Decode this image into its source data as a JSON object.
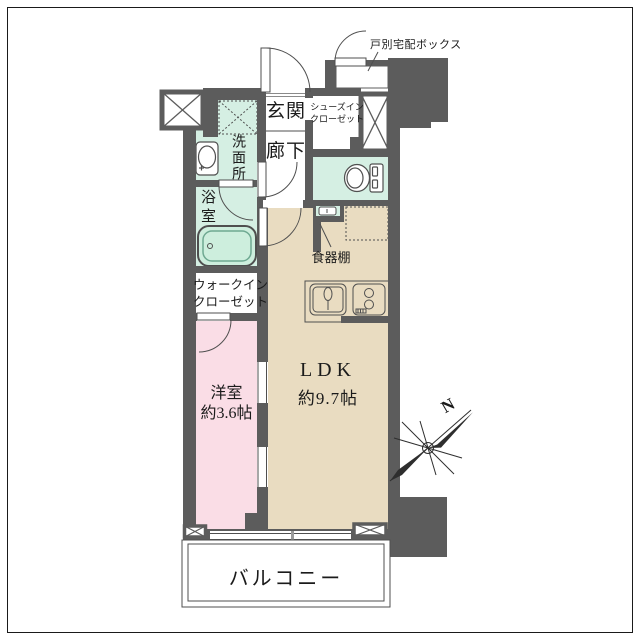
{
  "plan": {
    "labels": {
      "entrance": "玄関",
      "hallway": "廊下",
      "shoes_closet_line1": "シューズイン",
      "shoes_closet_line2": "クローゼット",
      "washroom": "洗面所",
      "bathroom": "浴室",
      "walk_in_closet_line1": "ウォークイン",
      "walk_in_closet_line2": "クローゼット",
      "bedroom_name": "洋室",
      "bedroom_size": "約3.6帖",
      "ldk_name": "LDK",
      "ldk_size": "約9.7帖",
      "cupboard": "食器棚",
      "balcony": "バルコニー",
      "delivery_box": "戸別宅配ボックス",
      "compass_north": "N"
    },
    "icons": {
      "toilet": "toilet-icon",
      "bathtub": "bathtub-icon",
      "washbasin": "washbasin-icon",
      "kitchen_sink": "kitchen-sink-icon",
      "stove": "stove-icon",
      "washer_space": "washing-machine-space-icon",
      "refrigerator_space": "refrigerator-space-icon",
      "compass": "compass-rose-icon",
      "pillar": "pillar-x-icon",
      "entrance_door": "swing-door-icon",
      "delivery_door": "swing-door-icon"
    },
    "colors": {
      "wall": "#5c5c5c",
      "wet_area": "#d5efe3",
      "living": "#e9dcc1",
      "bedroom": "#fadde6",
      "line": "#4f4f4f",
      "background": "#ffffff"
    }
  }
}
